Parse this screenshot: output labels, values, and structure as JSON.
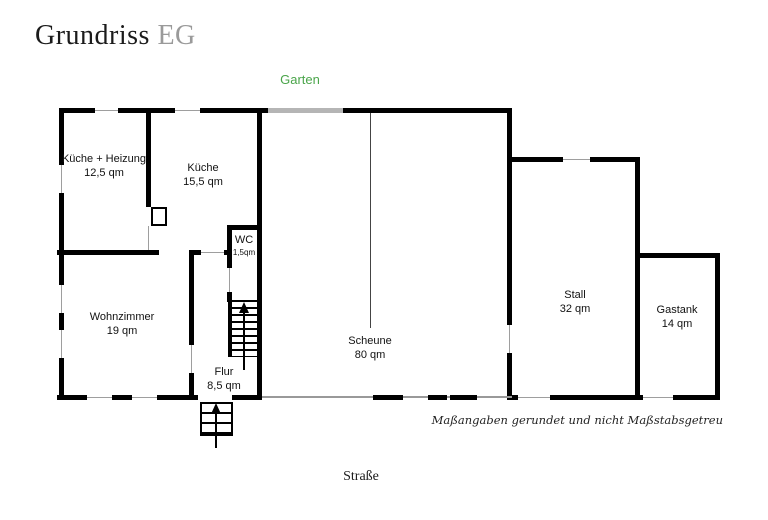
{
  "title": {
    "main": "Grundriss",
    "suffix": "EG"
  },
  "labels": {
    "garden": "Garten",
    "street": "Straße",
    "disclaimer": "Maßangaben gerundet und nicht Maßstabsgetreu"
  },
  "colors": {
    "garden_green": "#4aa54a",
    "title_suffix_gray": "#9a9a9a",
    "wall_black": "#000000",
    "window_line_gray": "#9e9e9e",
    "barn_door_gray": "#b5b5b5"
  },
  "rooms": [
    {
      "id": "kueche-heizung",
      "name": "Küche + Heizung",
      "area": "12,5 qm"
    },
    {
      "id": "kueche",
      "name": "Küche",
      "area": "15,5 qm"
    },
    {
      "id": "wc",
      "name": "WC",
      "area": "1,5qm"
    },
    {
      "id": "wohnzimmer",
      "name": "Wohnzimmer",
      "area": "19 qm"
    },
    {
      "id": "flur",
      "name": "Flur",
      "area": "8,5 qm"
    },
    {
      "id": "scheune",
      "name": "Scheune",
      "area": "80 qm"
    },
    {
      "id": "stall",
      "name": "Stall",
      "area": "32 qm"
    },
    {
      "id": "gastank",
      "name": "Gastank",
      "area": "14 qm"
    }
  ]
}
